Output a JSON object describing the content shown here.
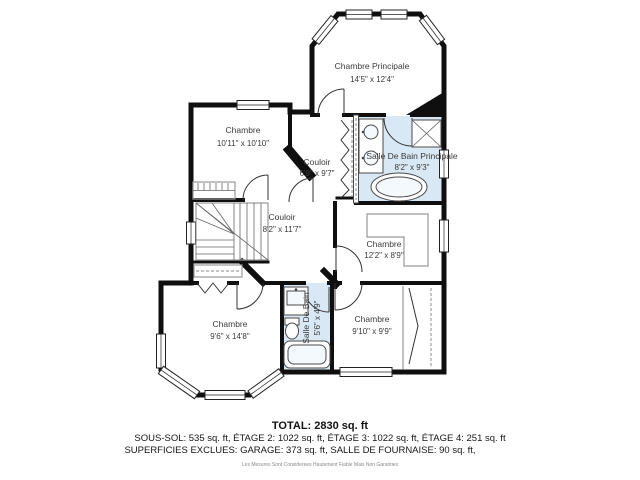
{
  "plan": {
    "master": {
      "name": "Chambre Principale",
      "dims": "14'5\" x 12'4\""
    },
    "bedroom_tl": {
      "name": "Chambre",
      "dims": "10'11\" x 10'10\""
    },
    "hall_upper": {
      "name": "Couloir",
      "dims": "6'9\" x 9'7\""
    },
    "bath_master": {
      "name": "Salle De Bain Principale",
      "dims": "8'2\" x 9'3\""
    },
    "hall_main": {
      "name": "Couloir",
      "dims": "8'2\" x 11'7\""
    },
    "bedroom_right": {
      "name": "Chambre",
      "dims": "12'2\" x 8'9\""
    },
    "bedroom_bl": {
      "name": "Chambre",
      "dims": "9'6\" x 14'8\""
    },
    "bath_small": {
      "name": "Salle De Bain",
      "dims": "5'6\" x 4'9\""
    },
    "bedroom_br": {
      "name": "Chambre",
      "dims": "9'10\" x 9'9\""
    }
  },
  "summary": {
    "total": "TOTAL: 2830 sq. ft",
    "areas": "SOUS-SOL: 535 sq. ft, ÉTAGE 2: 1022 sq. ft, ÉTAGE 3: 1022 sq. ft, ÉTAGE 4: 251 sq. ft",
    "exclusions": "SUPERFICIES EXCLUES: GARAGE: 373 sq. ft, SALLE DE FOURNAISE: 90 sq. ft,",
    "disclaimer": "Les Mesures Sont Considerees Hautement Fiable Mais Non Garanties"
  },
  "colors": {
    "wall": "#0f0f0f",
    "bath_fill": "#d8e8f4",
    "label": "#3a3a3a"
  }
}
